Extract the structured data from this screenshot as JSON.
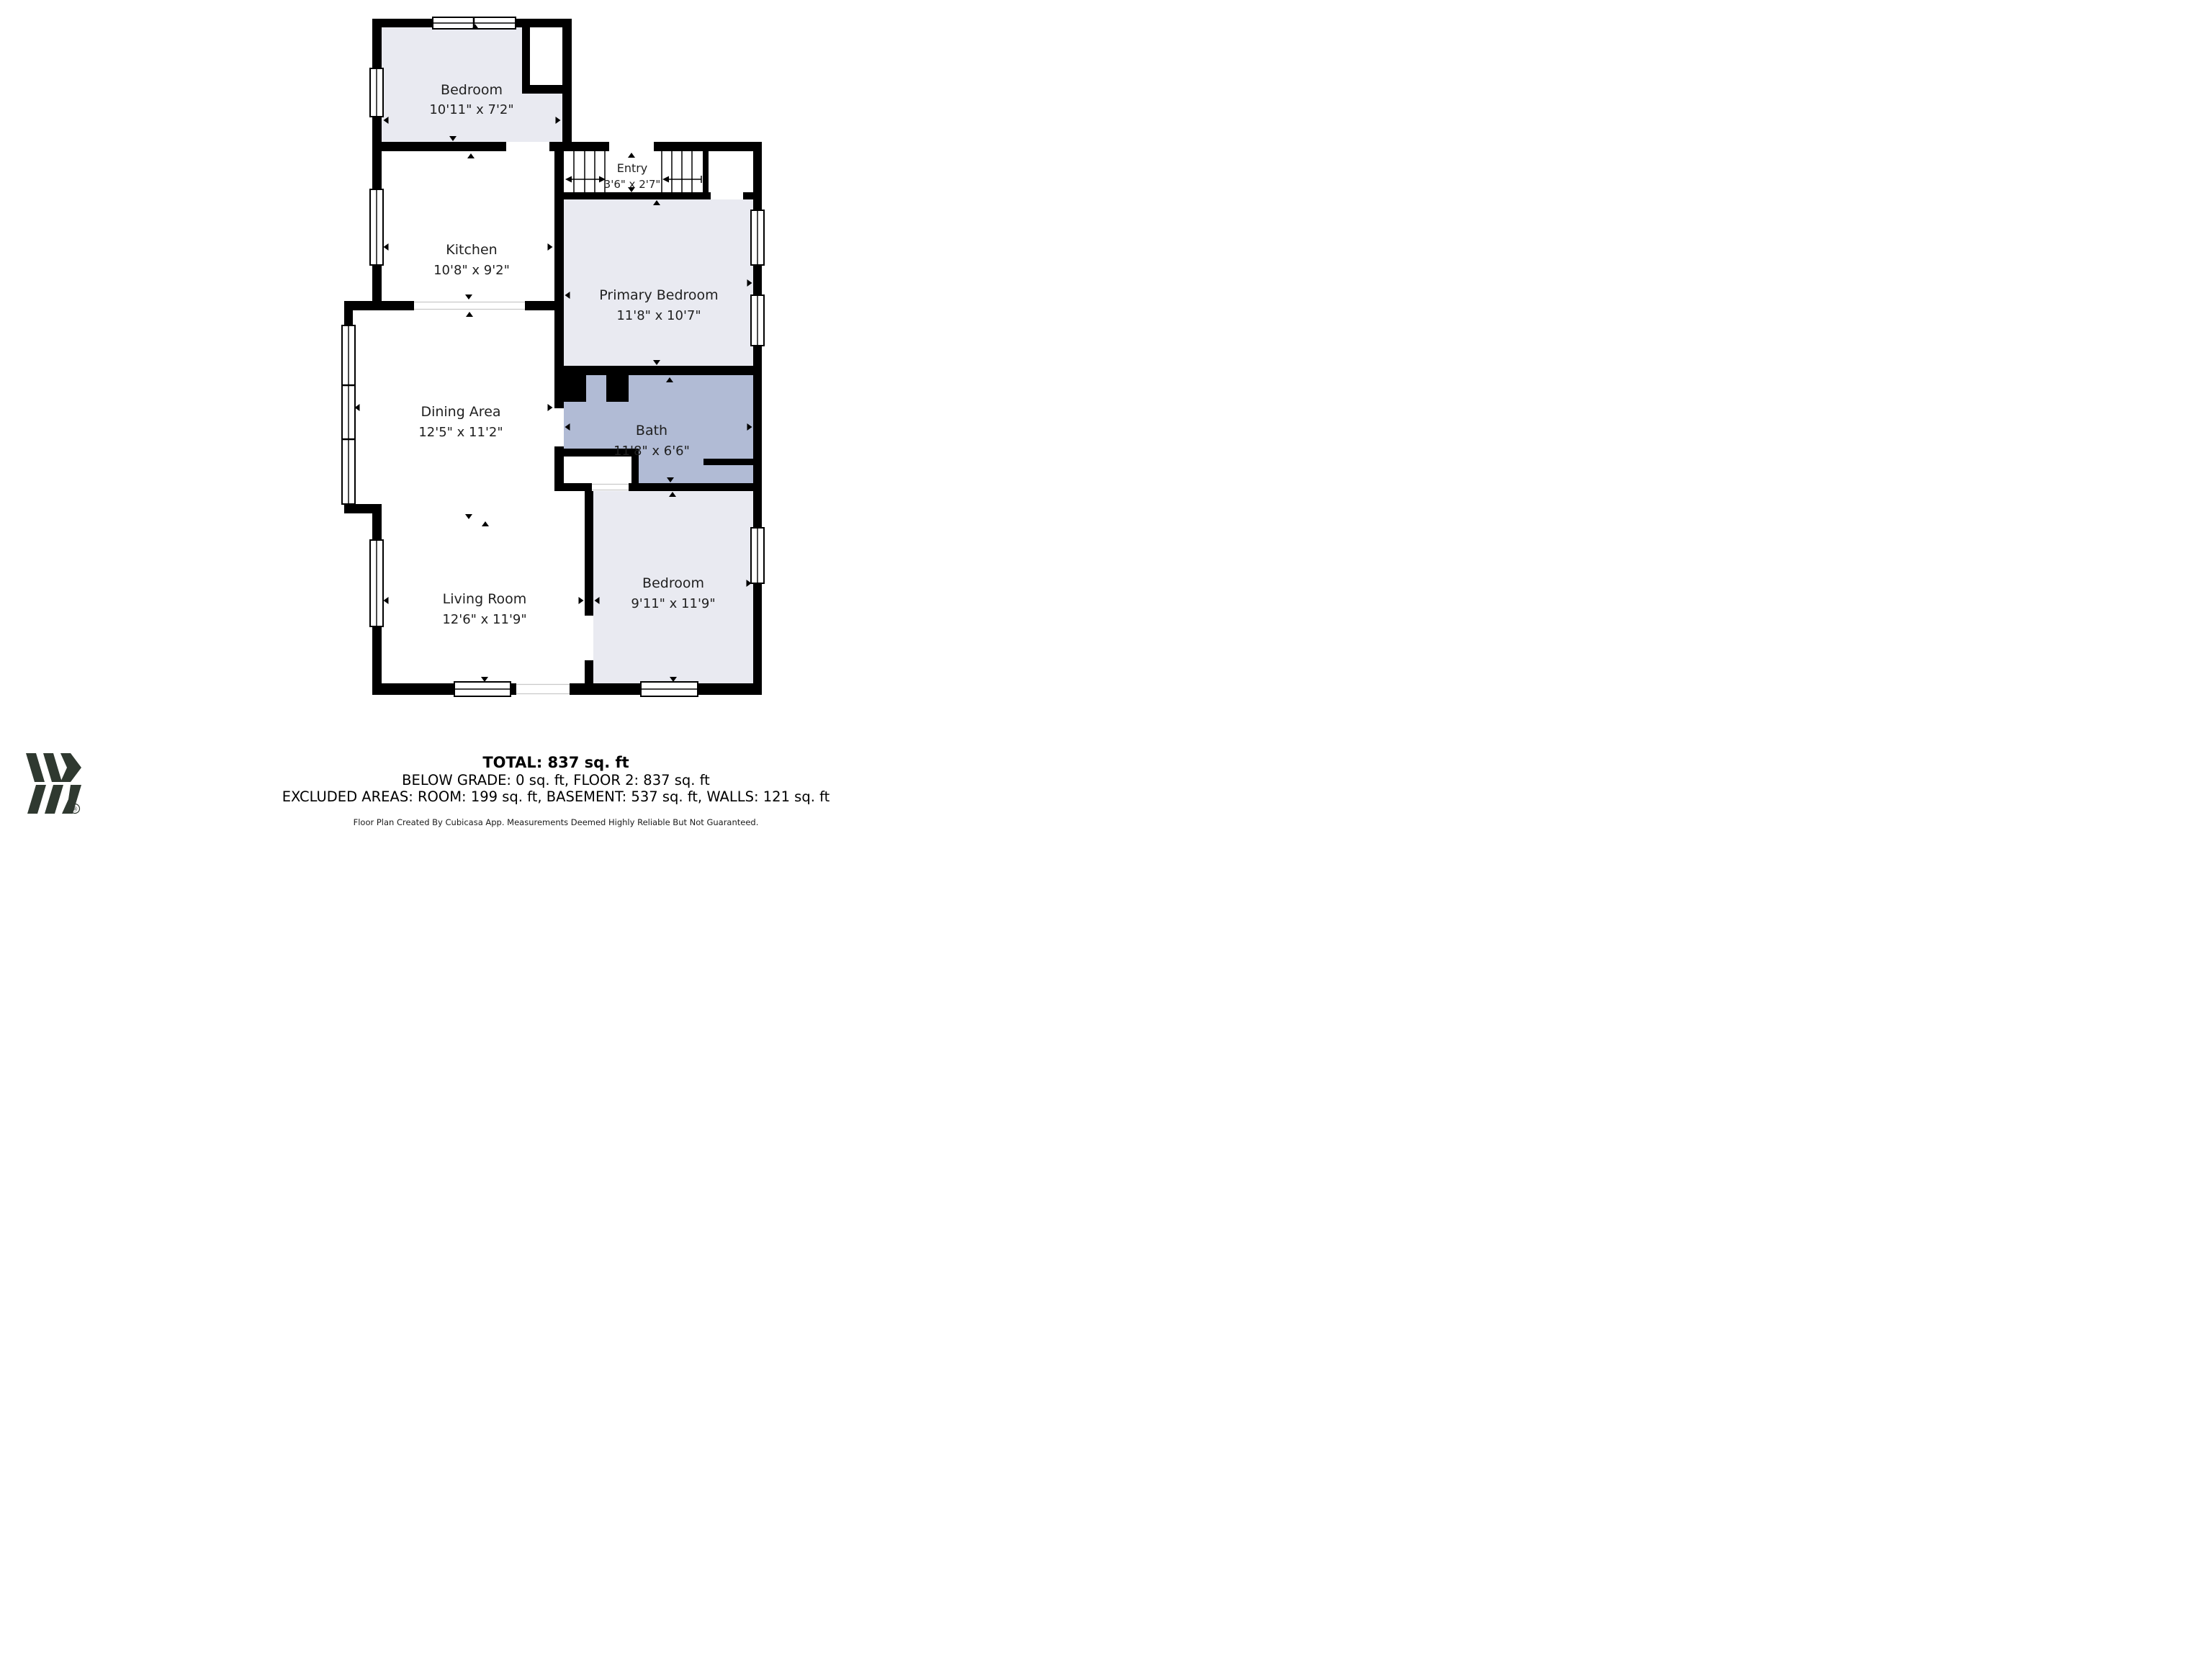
{
  "title": "Floor plan - Floor 2",
  "colors": {
    "wall": "#000000",
    "room_fill": "#e9eaf1",
    "bath_fill": "#b1bbd5",
    "white_room": "#ffffff",
    "logo_green": "#2f3930",
    "text": "#1f1f1f"
  },
  "rooms": [
    {
      "id": "bedroom-top",
      "name": "Bedroom",
      "dims": "10'11\" x 7'2\""
    },
    {
      "id": "entry",
      "name": "Entry",
      "dims": "3'6\" x 2'7\""
    },
    {
      "id": "kitchen",
      "name": "Kitchen",
      "dims": "10'8\" x 9'2\""
    },
    {
      "id": "primary-bedroom",
      "name": "Primary Bedroom",
      "dims": "11'8\" x 10'7\""
    },
    {
      "id": "dining-area",
      "name": "Dining Area",
      "dims": "12'5\" x 11'2\""
    },
    {
      "id": "bath",
      "name": "Bath",
      "dims": "11'8\" x 6'6\""
    },
    {
      "id": "living-room",
      "name": "Living Room",
      "dims": "12'6\" x 11'9\""
    },
    {
      "id": "bedroom-bottom",
      "name": "Bedroom",
      "dims": "9'11\" x 11'9\""
    }
  ],
  "summary": {
    "total": "TOTAL: 837 sq. ft",
    "below_grade": "BELOW GRADE: 0 sq. ft, FLOOR 2: 837 sq. ft",
    "excluded": "EXCLUDED AREAS: ROOM: 199 sq. ft, BASEMENT: 537 sq. ft, WALLS: 121 sq. ft",
    "disclaimer": "Floor Plan Created By Cubicasa App. Measurements Deemed Highly Reliable But Not Guaranteed."
  },
  "logo": {
    "name": "cubicasa-logo",
    "registered_mark": "®"
  }
}
